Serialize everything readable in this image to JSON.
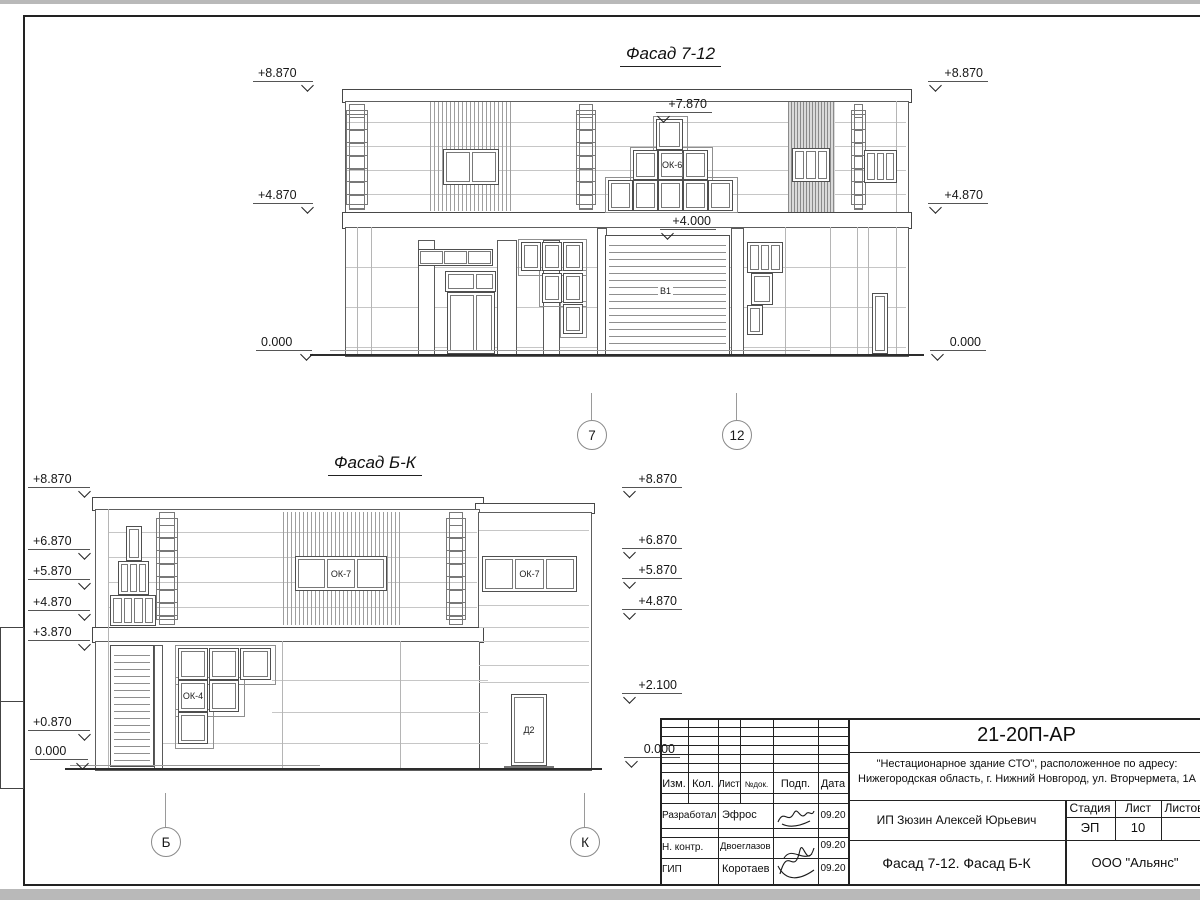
{
  "sheet": {
    "facade1": {
      "title": "Фасад 7-12",
      "marks_left": [
        "+8.870",
        "+4.870",
        "0.000"
      ],
      "marks_right": [
        "+8.870",
        "+4.870",
        "0.000"
      ],
      "marks_center": [
        "+7.870",
        "+4.000"
      ],
      "window_labels": {
        "ok6": "ОК-6",
        "v1": "В1"
      },
      "axes": [
        "7",
        "12"
      ]
    },
    "facade2": {
      "title": "Фасад Б-К",
      "marks_left": [
        "+8.870",
        "+6.870",
        "+5.870",
        "+4.870",
        "+3.870",
        "+0.870",
        "0.000"
      ],
      "marks_right": [
        "+8.870",
        "+6.870",
        "+5.870",
        "+4.870",
        "+2.100",
        "0.000"
      ],
      "window_labels": {
        "ok7": "ОК-7",
        "ok4": "ОК-4",
        "d2": "Д2"
      },
      "axes": [
        "Б",
        "К"
      ]
    },
    "titleblock": {
      "doc_number": "21-20П-АР",
      "project_line1": "\"Нестационарное здание СТО\", расположенное по адресу:",
      "project_line2": "Нижегородская область, г. Нижний Новгород, ул. Вторчермета, 1А",
      "columns": [
        "Изм.",
        "Кол.",
        "Лист",
        "№док.",
        "Подп.",
        "Дата"
      ],
      "rows": [
        {
          "role": "Разработал",
          "name": "Эфрос",
          "date": "09.20"
        },
        {
          "role": "Н. контр.",
          "name": "Двоеглазов",
          "date": "09.20"
        },
        {
          "role": "ГИП",
          "name": "Коротаев",
          "date": "09.20"
        }
      ],
      "client": "ИП Зюзин Алексей Юрьевич",
      "stage_label": "Стадия",
      "sheet_label": "Лист",
      "sheets_label": "Листов",
      "stage": "ЭП",
      "sheet_number": "10",
      "drawing_title": "Фасад 7-12. Фасад Б-К",
      "company": "ООО \"Альянс\""
    }
  }
}
